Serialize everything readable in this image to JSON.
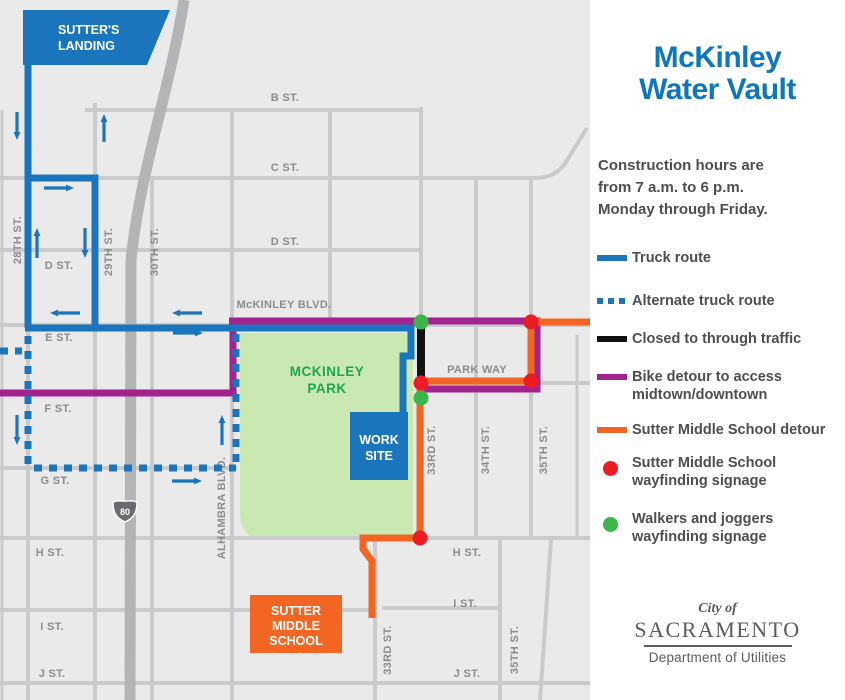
{
  "colors": {
    "blue": "#1B75BC",
    "title_blue": "#0E76BD",
    "purple": "#A3238E",
    "orange": "#F26522",
    "route_black": "#111111",
    "red": "#EC1C24",
    "green": "#3CB54A",
    "park_fill": "#C9E8B2",
    "park_text": "#1FA64A",
    "street": "#C9CACB",
    "freeway": "#B3B4B6",
    "bg": "#EAEAEA",
    "label": "#8A8C8F",
    "dark": "#4D4E50",
    "logo_gray": "#5B5C5E",
    "shield_gray": "#6A6B6E"
  },
  "map": {
    "sutters_landing": {
      "line1": "SUTTER'S",
      "line2": "LANDING"
    },
    "work_site": {
      "line1": "WORK",
      "line2": "SITE"
    },
    "school": {
      "line1": "SUTTER",
      "line2": "MIDDLE",
      "line3": "SCHOOL"
    },
    "park": {
      "line1": "MCKINLEY",
      "line2": "PARK"
    },
    "freeway_shield": "80",
    "labels": {
      "b_st": "B ST.",
      "c_st": "C ST.",
      "d_st_e": "D ST.",
      "d_st_w": "D ST.",
      "mckinley_blvd": "McKINLEY BLVD.",
      "e_st": "E ST.",
      "f_st": "F ST.",
      "park_way": "PARK WAY",
      "g_st": "G ST.",
      "h_st_w": "H ST.",
      "h_st_e": "H ST.",
      "i_st_w": "I ST.",
      "i_st_e": "I ST.",
      "j_st_w": "J ST.",
      "j_st_e": "J ST.",
      "st28": "28TH ST.",
      "st29": "29TH ST.",
      "st30": "30TH ST.",
      "alhambra": "ALHAMBRA BLVD.",
      "st33_n": "33RD ST.",
      "st33_s": "33RD ST.",
      "st34": "34TH ST.",
      "st35_n": "35TH ST.",
      "st35_s": "35TH ST."
    }
  },
  "panel": {
    "title_line1": "McKinley",
    "title_line2": "Water Vault",
    "hours_line1": "Construction hours are",
    "hours_line2": "from 7 a.m. to 6 p.m.",
    "hours_line3": "Monday through Friday.",
    "legend": [
      {
        "line1": "Truck route"
      },
      {
        "line1": "Alternate truck route"
      },
      {
        "line1": "Closed to through traffic"
      },
      {
        "line1": "Bike detour to access",
        "line2": "midtown/downtown"
      },
      {
        "line1": "Sutter Middle School detour"
      },
      {
        "line1": "Sutter Middle School",
        "line2": "wayfinding signage"
      },
      {
        "line1": "Walkers and joggers",
        "line2": "wayfinding signage"
      }
    ],
    "logo": {
      "city_of": "City of",
      "name": "SACRAMENTO",
      "dept": "Department of Utilities"
    }
  }
}
